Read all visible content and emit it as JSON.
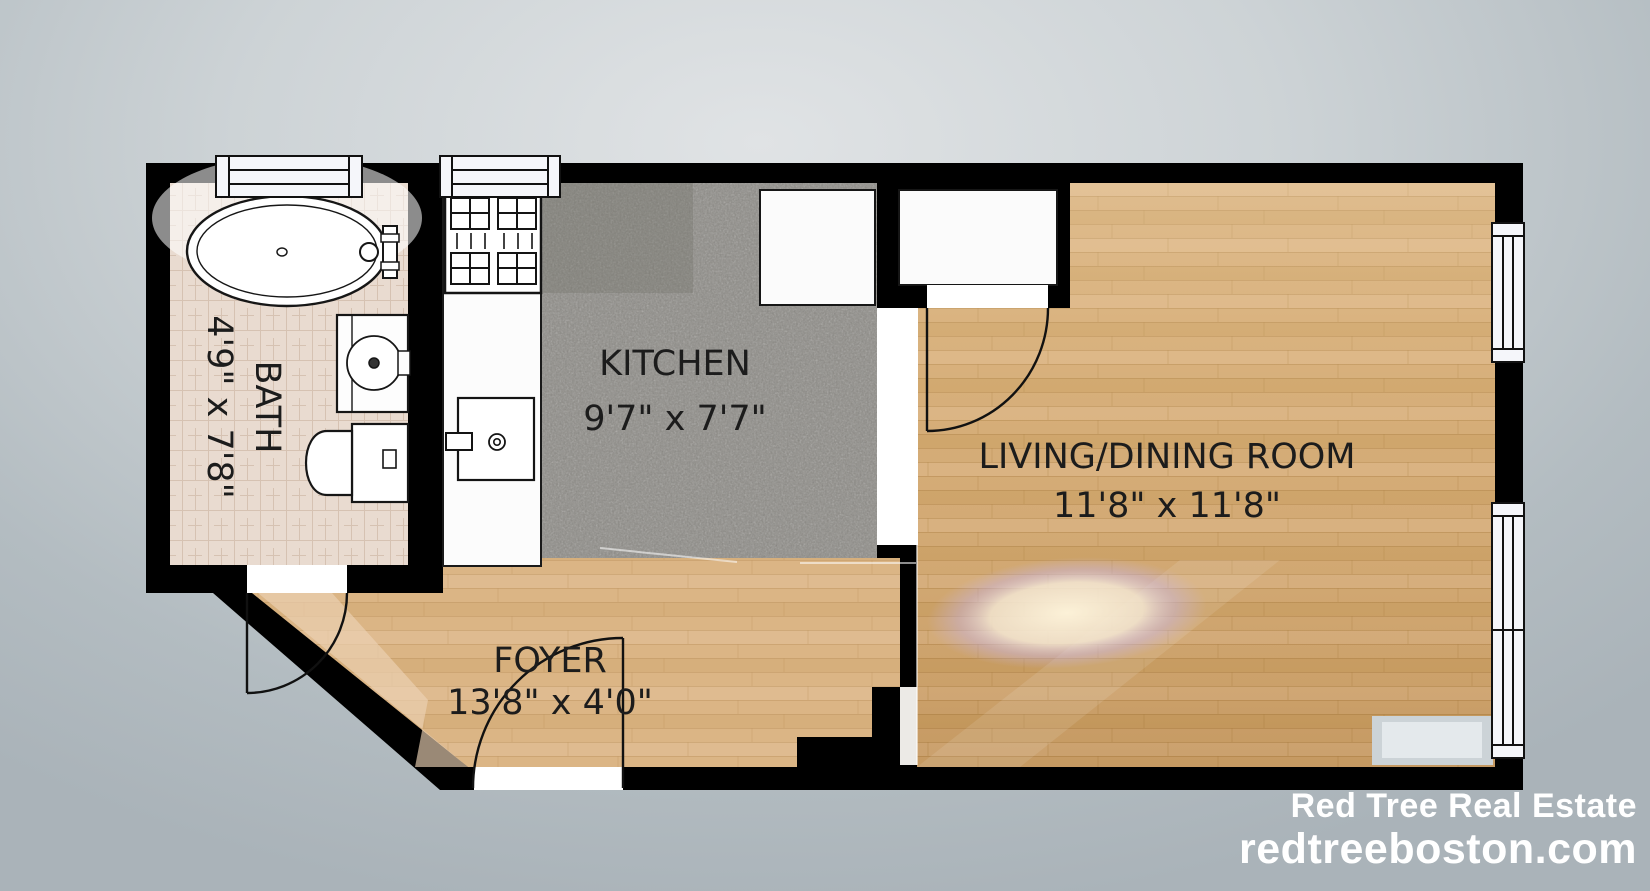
{
  "plan": {
    "rooms": {
      "bath": {
        "name": "BATH",
        "dims": "4'9\" x 7'8\"",
        "floor": "tile"
      },
      "kitchen": {
        "name": "KITCHEN",
        "dims": "9'7\" x 7'7\"",
        "floor": "granite"
      },
      "living": {
        "name": "LIVING/DINING ROOM",
        "dims": "11'8\" x 11'8\"",
        "floor": "hardwood"
      },
      "foyer": {
        "name": "FOYER",
        "dims": "13'8\" x 4'0\"",
        "floor": "hardwood"
      }
    },
    "fixtures": [
      "bathtub",
      "bath-vanity-sink",
      "toilet",
      "range",
      "kitchen-sink",
      "refrigerator",
      "closet",
      "radiator"
    ],
    "window_count": 4,
    "door_count": 3,
    "colors": {
      "wall": "#000000",
      "hardwood": "#d1a873",
      "granite": "#8d8b86",
      "tile": "#e8dacf",
      "fixture_fill": "#fdfdfd",
      "background": "#c6cdd1",
      "label_text": "#1c1c1c"
    }
  },
  "watermark": {
    "line1": "Red Tree Real Estate",
    "line2": "redtreeboston.com",
    "color": "#ffffff"
  }
}
